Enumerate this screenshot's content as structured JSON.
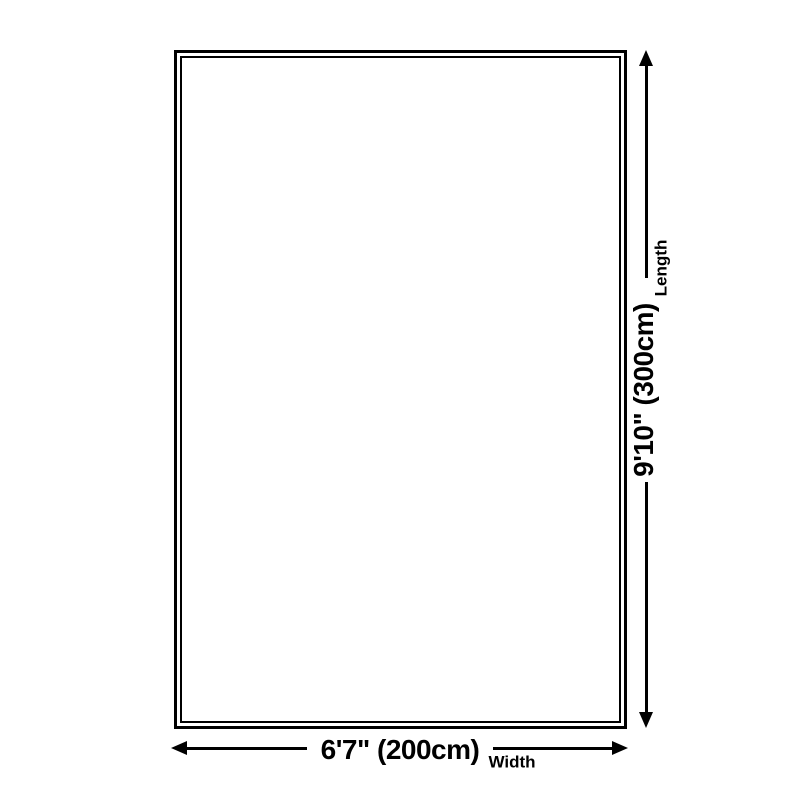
{
  "diagram": {
    "background_color": "#ffffff",
    "line_color": "#000000",
    "length_dimension": {
      "value": "9'10\" (300cm)",
      "label": "Length"
    },
    "width_dimension": {
      "value": "6'7\" (200cm)",
      "label": "Width"
    }
  }
}
